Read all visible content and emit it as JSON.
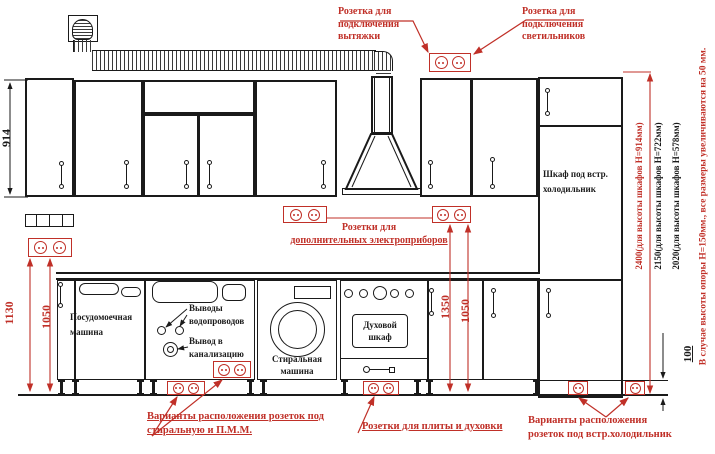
{
  "colors": {
    "annotation_red": "#c03028",
    "ink": "#1a1a1a",
    "background": "#ffffff"
  },
  "annotations": {
    "hood_socket": {
      "line1": "Розетка для",
      "line2": "подключения",
      "line3": "вытяжки"
    },
    "lights_socket": {
      "line1": "Розетка для",
      "line2": "подключения",
      "line3": "светильников"
    },
    "extra_appliance_sockets": {
      "line1": "Розетки для",
      "line2": "дополнительных электроприборов"
    },
    "washer_dishwasher_sockets": {
      "line1": "Варианты расположения розеток под",
      "line2": "стиральную и П.М.М."
    },
    "stove_oven_sockets": {
      "line1": "Розетки для плиты и духовки"
    },
    "fridge_sockets": {
      "line1": "Варианты расположения",
      "line2": "розеток под встр.холодильник"
    },
    "support_note": "В случае высоты опоры H=150мм., все размеры увеличиваются на 50 мм."
  },
  "dimensions": {
    "upper_cabinet_height": "914",
    "left_socket_top": "1130",
    "left_socket_bottom": "1050",
    "mid_socket_top": "1350",
    "mid_socket_bottom": "1050",
    "total_height_h914": "2400(для высоты шкафов H=914мм)",
    "total_height_h722": "2150(для высоты шкафов H=722мм)",
    "total_height_h578": "2020(для высоты шкафов H=578мм)",
    "plinth_height": "100"
  },
  "appliances": {
    "dishwasher": {
      "line1": "Посудомоечная",
      "line2": "машина"
    },
    "washing_machine": {
      "line1": "Стиральная",
      "line2": "машина"
    },
    "oven": {
      "line1": "Духовой",
      "line2": "шкаф"
    },
    "fridge_cabinet": {
      "line1": "Шкаф под встр.",
      "line2": "холодильник"
    },
    "water_supply": {
      "line1": "Выводы",
      "line2": "водопроводов"
    },
    "sewage": {
      "line1": "Вывод в",
      "line2": "канализацию"
    }
  }
}
